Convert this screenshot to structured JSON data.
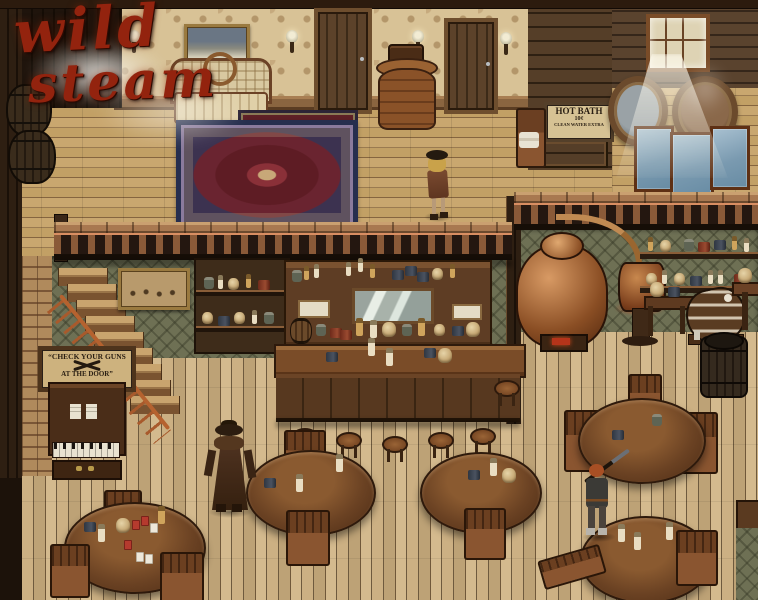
{
  "scene": {
    "name": "Wild Steam — Saloon Interior",
    "style": "top-down pixel-art RPG scene"
  },
  "logo": {
    "word1": "wild",
    "word2": "steam",
    "color": "#93230e"
  },
  "signs": {
    "hot_bath": {
      "line1": "HOT BATH",
      "line2": "10¢",
      "line3": "CLEAN WATER EXTRA"
    },
    "check_guns": {
      "line1": "“CHECK YOUR GUNS",
      "line2": "AT THE DOOR”"
    }
  },
  "characters": [
    {
      "id": "saloon-girl",
      "desc": "blonde woman in dark hat walking on balcony"
    },
    {
      "id": "duster-cowboy",
      "desc": "cowboy in long brown duster coat and hat on saloon floor"
    },
    {
      "id": "rifle-hunter",
      "desc": "red-haired hunter carrying a rifle over the shoulder"
    }
  ],
  "palette": {
    "floor_tan": "#c9ae7e",
    "wall_olive": "#6e7054",
    "wallpaper_beige": "#d8c296",
    "wood_dark": "#3a2a18",
    "copper": "#c08a52",
    "logo_red": "#93230e"
  }
}
